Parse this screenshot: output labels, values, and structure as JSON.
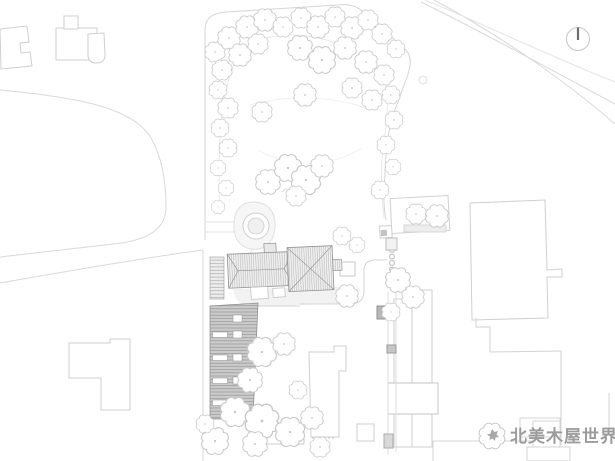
{
  "drawing": {
    "type": "architectural site plan"
  },
  "watermark": {
    "text": "北美木屋世界",
    "logo": "maple-leaf-cloud"
  },
  "compass": {
    "icon": "north-arrow",
    "direction": "N"
  },
  "colors": {
    "background": "#ffffff",
    "context_outline": "#cfcfcf",
    "road_line": "#d9d9d9",
    "park_boundary": "#d5d5d5",
    "tree_stroke": "#c9c9c9",
    "house_stroke": "#8f8f8f",
    "roof_hatch": "#b6b6b6",
    "trellis_fill": "#cbcbcb",
    "trellis_line": "#9a9a9a",
    "watermark_text": "#9b9b9b",
    "north_needle": "#6e6e6e"
  }
}
